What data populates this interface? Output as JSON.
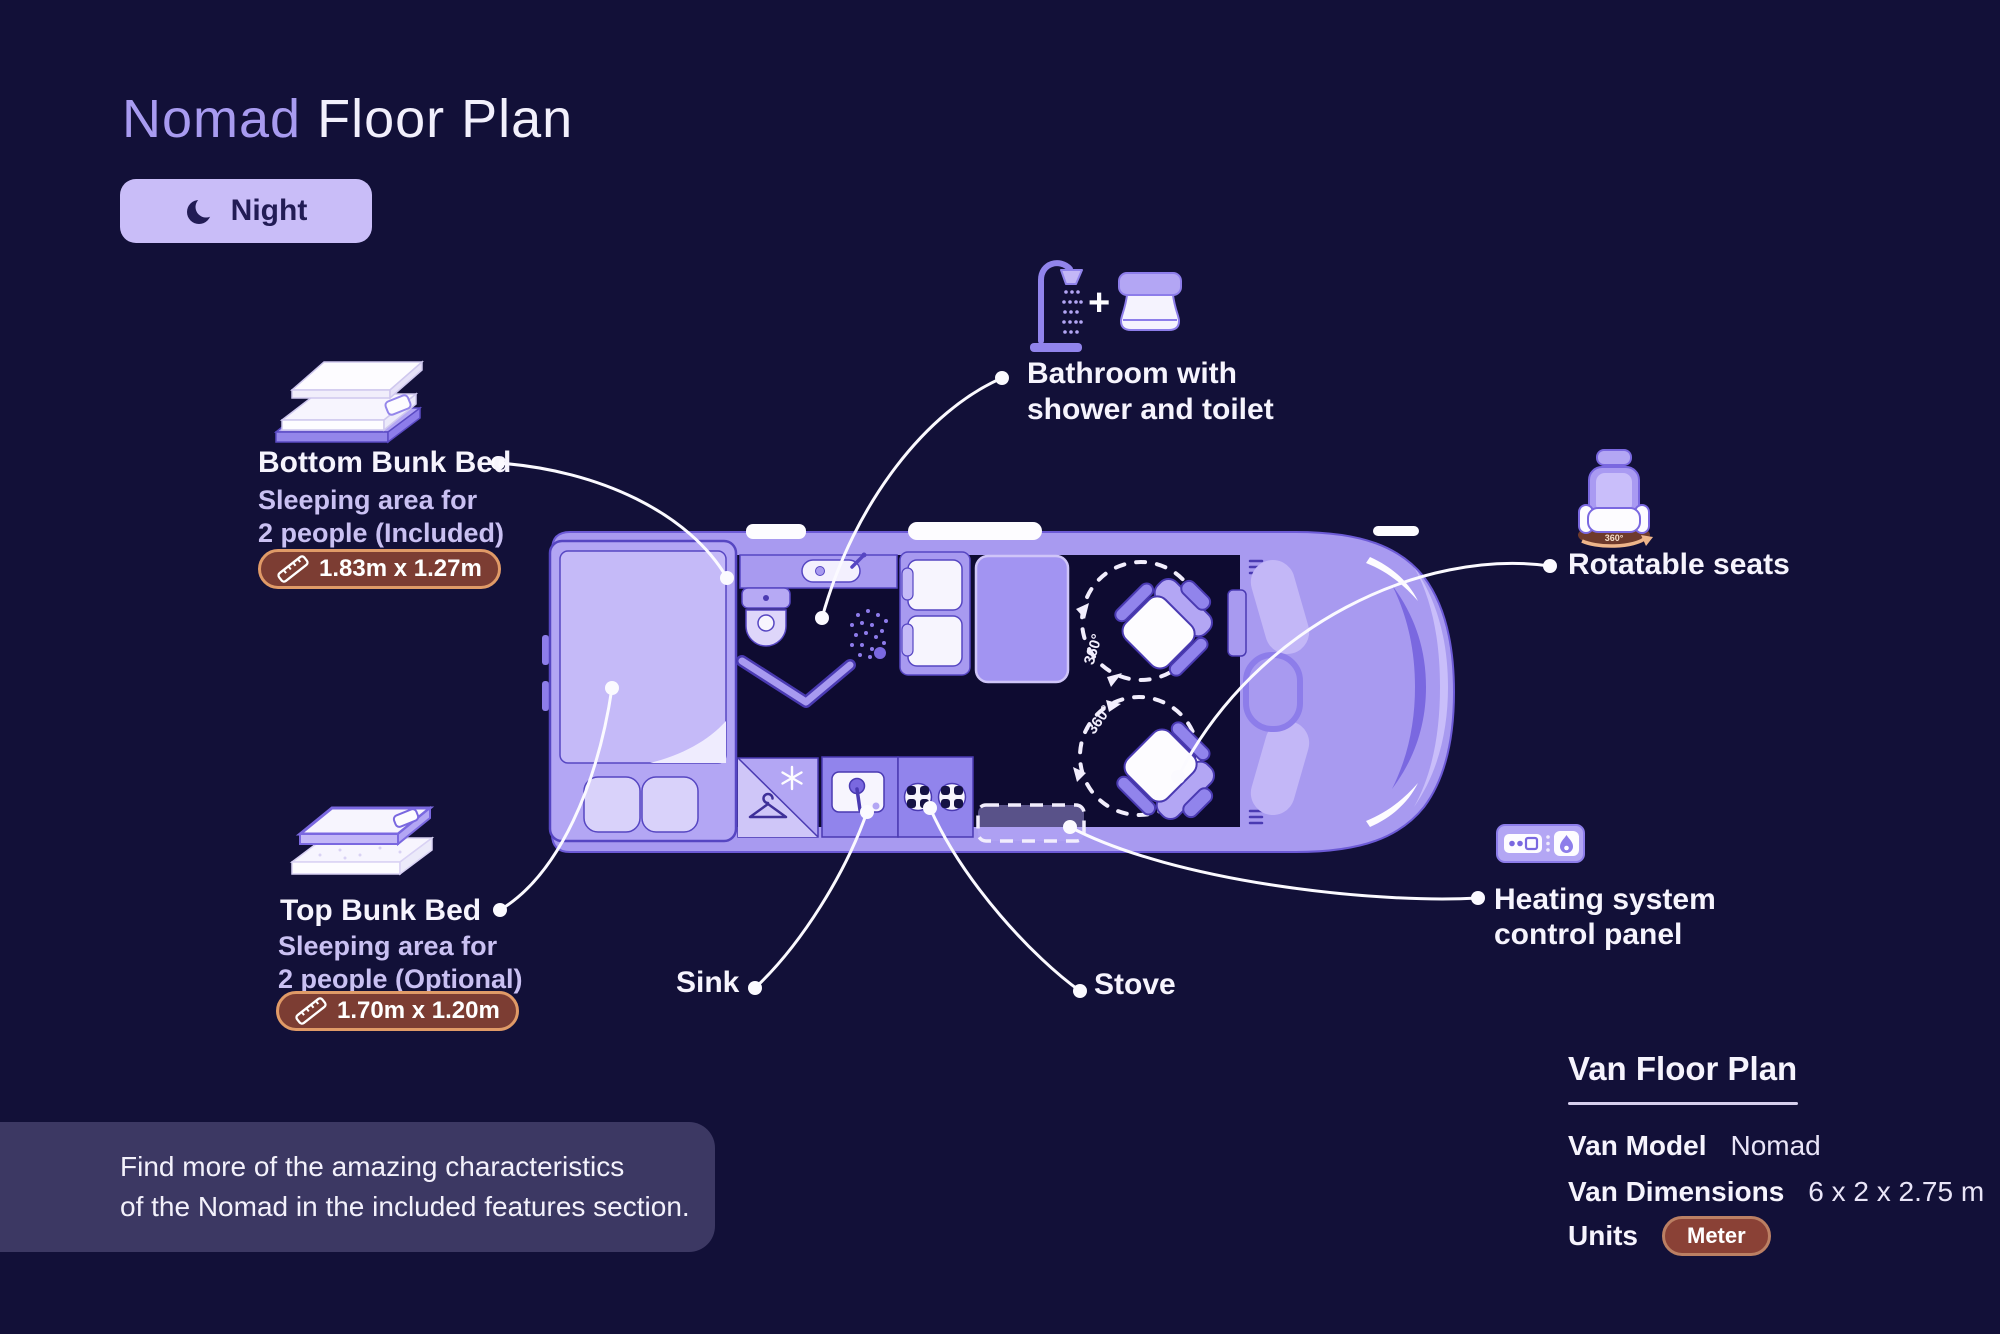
{
  "title": {
    "brand": "Nomad",
    "rest": "Floor Plan"
  },
  "mode_toggle": {
    "label": "Night"
  },
  "annotations": {
    "bottom_bunk": {
      "title": "Bottom Bunk Bed",
      "desc_line1": "Sleeping area for",
      "desc_line2": "2 people (Included)",
      "dimensions": "1.83m x 1.27m"
    },
    "top_bunk": {
      "title": "Top Bunk Bed",
      "desc_line1": "Sleeping area for",
      "desc_line2": "2 people (Optional)",
      "dimensions": "1.70m x 1.20m"
    },
    "bathroom": {
      "line1": "Bathroom with",
      "line2": "shower and toilet",
      "plus": "+"
    },
    "rotatable_seats": {
      "label": "Rotatable seats",
      "rotation": "360°"
    },
    "heating": {
      "line1": "Heating system",
      "line2": "control panel"
    },
    "sink": {
      "label": "Sink"
    },
    "stove": {
      "label": "Stove"
    }
  },
  "floorplan": {
    "seat_rotation_label": "360°"
  },
  "note": {
    "line1": "Find more of the amazing characteristics",
    "line2": "of the Nomad in the included features section."
  },
  "info_panel": {
    "title": "Van Floor Plan",
    "rows": [
      {
        "label": "Van Model",
        "value": "Nomad"
      },
      {
        "label": "Van Dimensions",
        "value": "6 x 2 x 2.75 m"
      },
      {
        "label": "Units",
        "value": "Meter"
      }
    ]
  },
  "colors": {
    "background": "#121038",
    "accent_purple": "#a89bf0",
    "light_lavender": "#c9bdf8",
    "van_body": "#a89af0",
    "badge_bg": "#7c3d33",
    "badge_border": "#e09a67",
    "note_panel_bg": "#3c3863",
    "white": "#fdfcff"
  }
}
